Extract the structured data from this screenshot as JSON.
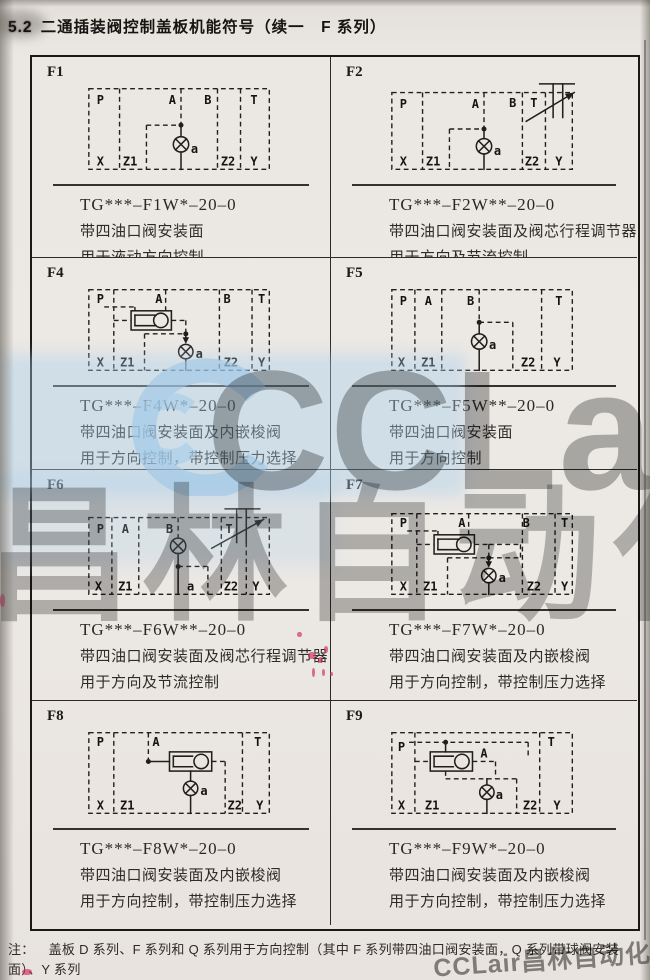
{
  "page": {
    "title_no": "5.2",
    "title_text": "二通插装阀控制盖板机能符号（续一　F 系列）"
  },
  "note": {
    "label": "注：",
    "line1": "盖板 D 系列、F 系列和 Q 系列用于方向控制（其中 F 系列带四油口阀安装面，Q 系列带球阀安装面）、Y 系列",
    "line2": "用于压力控制；J 系列用于组成减压控制单元。"
  },
  "watermark": {
    "brand": "CCLair",
    "brand_cn": "昌林自动化",
    "footer": "CCLair昌林自动化",
    "accent_blue": "#a8cee9",
    "gray": "#7a7a7a"
  },
  "cells": [
    {
      "id": "F1",
      "code": "TG***–F1W*–20–0",
      "desc1": "带四油口阀安装面",
      "desc2": "用于液动方向控制",
      "top": [
        "P",
        "A",
        "B",
        "T"
      ],
      "bottom": [
        "X",
        "Z1",
        "a",
        "Z2",
        "Y"
      ]
    },
    {
      "id": "F2",
      "code": "TG***–F2W**–20–0",
      "desc1": "带四油口阀安装面及阀芯行程调节器",
      "desc2": "用于方向及节流控制",
      "top": [
        "P",
        "A",
        "B",
        "T"
      ],
      "bottom": [
        "X",
        "Z1",
        "a",
        "Z2",
        "Y"
      ]
    },
    {
      "id": "F4",
      "code": "TG***–F4W*–20–0",
      "desc1": "带四油口阀安装面及内嵌梭阀",
      "desc2": "用于方向控制，带控制压力选择",
      "top": [
        "P",
        "A",
        "B",
        "T"
      ],
      "bottom": [
        "X",
        "Z1",
        "a",
        "Z2",
        "Y"
      ]
    },
    {
      "id": "F5",
      "code": "TG***–F5W**–20–0",
      "desc1": "带四油口阀安装面",
      "desc2": "用于方向控制",
      "top": [
        "P",
        "A",
        "B",
        "T"
      ],
      "bottom": [
        "X",
        "Z1",
        "a",
        "Z2",
        "Y"
      ]
    },
    {
      "id": "F6",
      "code": "TG***–F6W**–20–0",
      "desc1": "带四油口阀安装面及阀芯行程调节器",
      "desc2": "用于方向及节流控制",
      "top": [
        "P",
        "A",
        "B",
        "T"
      ],
      "bottom": [
        "X",
        "Z1",
        "a",
        "Z2",
        "Y"
      ]
    },
    {
      "id": "F7",
      "code": "TG***–F7W*–20–0",
      "desc1": "带四油口阀安装面及内嵌梭阀",
      "desc2": "用于方向控制，带控制压力选择",
      "top": [
        "P",
        "A",
        "B",
        "T"
      ],
      "bottom": [
        "X",
        "Z1",
        "a",
        "Z2",
        "Y"
      ]
    },
    {
      "id": "F8",
      "code": "TG***–F8W*–20–0",
      "desc1": "带四油口阀安装面及内嵌梭阀",
      "desc2": "用于方向控制，带控制压力选择",
      "top": [
        "P",
        "A",
        "T"
      ],
      "bottom": [
        "X",
        "Z1",
        "a",
        "Z2",
        "Y"
      ]
    },
    {
      "id": "F9",
      "code": "TG***–F9W*–20–0",
      "desc1": "带四油口阀安装面及内嵌梭阀",
      "desc2": "用于方向控制，带控制压力选择",
      "top": [
        "P",
        "A",
        "T"
      ],
      "bottom": [
        "X",
        "Z1",
        "a",
        "Z2",
        "Y"
      ]
    }
  ]
}
